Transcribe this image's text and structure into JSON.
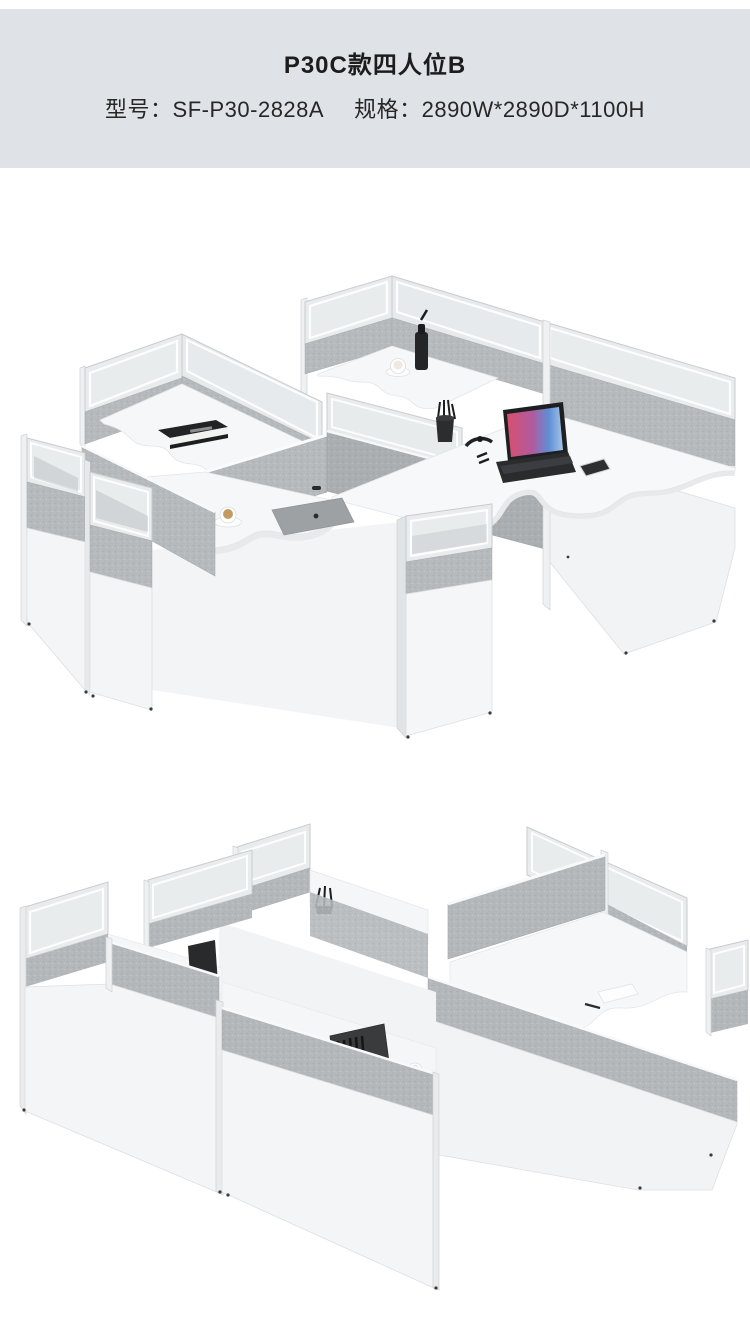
{
  "header": {
    "title": "P30C款四人位B",
    "model_label": "型号：",
    "model_value": "SF-P30-2828A",
    "spec_label": "规格：",
    "spec_value": "2890W*2890D*1100H",
    "background": "#dfe3e8",
    "text_color": "#1c1c1c"
  },
  "renders": {
    "top": {
      "alt": "四人位屏风办公桌 正面俯视效果图：白色桌面、灰色屏风布艺隔断、磨砂玻璃上挡板，桌面摆放书本、水瓶、咖啡杯、笔筒、手表、笔记本电脑、手机、桌垫",
      "props": [
        "书本",
        "水瓶",
        "咖啡杯",
        "笔筒",
        "手表",
        "笔记本电脑",
        "手机",
        "桌垫"
      ]
    },
    "bottom": {
      "alt": "四人位屏风办公桌 背面效果图：灰白屏风隔断与磨砂玻璃挡板，桌面可见显示器背面、手机、咖啡杯、便签和笔",
      "props": [
        "显示器背面",
        "手机",
        "咖啡杯",
        "便签",
        "笔"
      ]
    }
  },
  "palette": {
    "page_background": "#ffffff",
    "header_background": "#dfe3e8",
    "panel_white": "#f4f5f7",
    "panel_frame": "#c9ccce",
    "panel_glass": "#e9eced",
    "panel_fabric": "#b6babd",
    "desk_surface": "#f7f8fa",
    "item_dark": "#28292b",
    "laptop_screen_pink": "#d94f6e",
    "laptop_screen_violet": "#b05a9e",
    "laptop_screen_blue": "#5f8fd6",
    "coffee": "#c59a62",
    "watermark": "#eceff0"
  }
}
